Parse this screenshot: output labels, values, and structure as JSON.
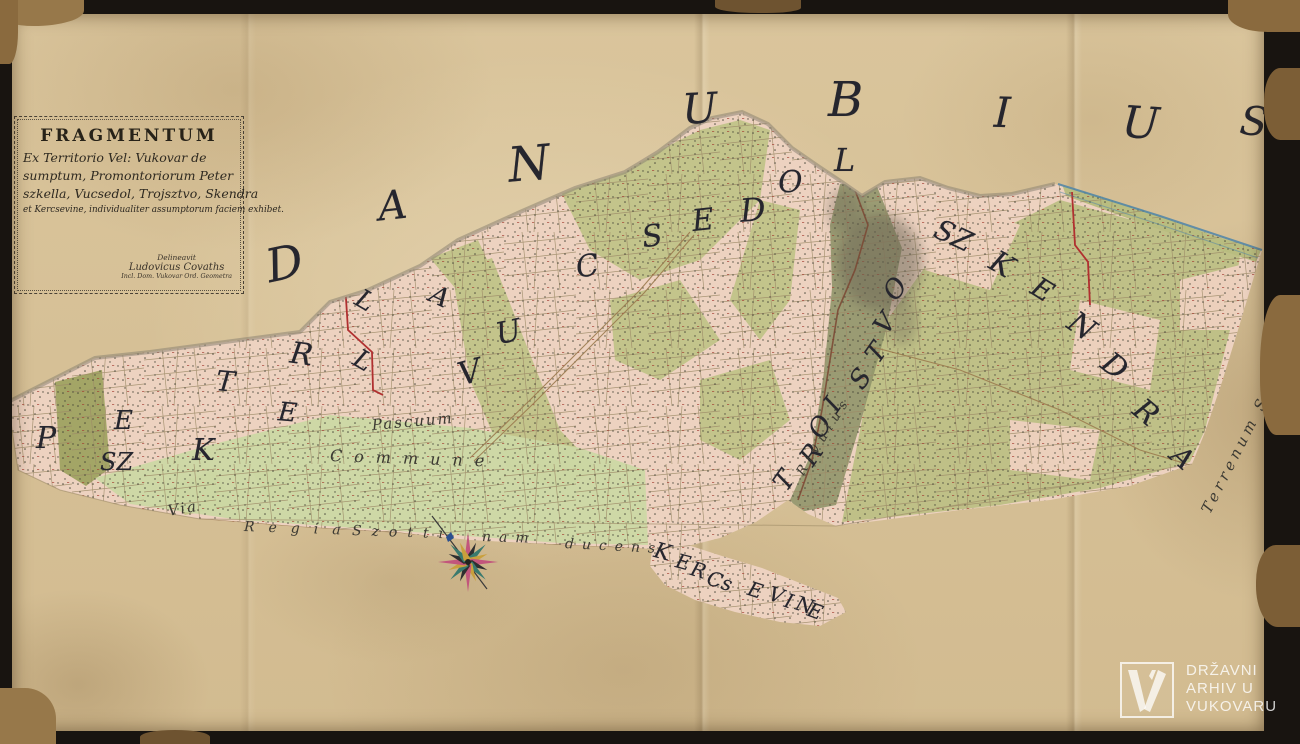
{
  "cartouche": {
    "title": "FRAGMENTUM",
    "line2": "Ex Territorio Vel: Vukovar de",
    "line3": "sumptum, Promontoriorum Peter",
    "line4": "szkella, Vucsedol, Trojsztvo, Skendra",
    "line5": "et Kercsevine, individualiter assumptorum faciem exhibet.",
    "signature": {
      "line1": "Delineavit",
      "line2": "Ludovicus Covaths",
      "line3": "Incl. Dom. Vukovar Ord. Geometra"
    }
  },
  "river_name": "DANUBIUS",
  "region_names": [
    "PETERSZKELLA",
    "VUCSEDOL",
    "TROISTVO",
    "SZKENDRA",
    "KERCSEVINE"
  ],
  "lettering": [
    {
      "name": "danubius",
      "cls": "river",
      "letters": [
        [
          "D",
          266,
          240,
          46,
          -12
        ],
        [
          "A",
          378,
          186,
          40,
          -6
        ],
        [
          "N",
          508,
          140,
          48,
          -5
        ],
        [
          "U",
          682,
          88,
          42,
          -3
        ],
        [
          "B",
          828,
          76,
          48,
          0
        ],
        [
          "I",
          994,
          92,
          42,
          2
        ],
        [
          "U",
          1122,
          102,
          44,
          4
        ],
        [
          "S",
          1240,
          102,
          40,
          6
        ]
      ]
    },
    {
      "name": "peterszkella",
      "cls": "region",
      "letters": [
        [
          "P",
          36,
          424,
          30,
          0
        ],
        [
          "E",
          114,
          408,
          26,
          0
        ],
        [
          "SZ",
          100,
          450,
          24,
          0
        ],
        [
          "K",
          192,
          436,
          30,
          0
        ],
        [
          "T",
          216,
          368,
          28,
          5
        ],
        [
          "E",
          278,
          400,
          26,
          5
        ],
        [
          "R",
          290,
          340,
          30,
          8
        ],
        [
          "L",
          354,
          348,
          26,
          30
        ],
        [
          "L",
          356,
          288,
          26,
          30
        ],
        [
          "A",
          430,
          284,
          26,
          25
        ]
      ]
    },
    {
      "name": "vucsedol",
      "cls": "region",
      "letters": [
        [
          "V",
          458,
          356,
          32,
          -15
        ],
        [
          "U",
          496,
          318,
          30,
          -12
        ],
        [
          "C",
          576,
          252,
          30,
          -10
        ],
        [
          "S",
          642,
          222,
          30,
          -8
        ],
        [
          "E",
          692,
          206,
          30,
          -6
        ],
        [
          "D",
          740,
          194,
          32,
          -4
        ],
        [
          "O",
          778,
          168,
          30,
          -2
        ],
        [
          "L",
          834,
          144,
          32,
          0
        ]
      ]
    },
    {
      "name": "troistvo",
      "cls": "region",
      "letters": [
        [
          "T",
          776,
          468,
          26,
          -55
        ],
        [
          "R",
          802,
          442,
          26,
          -55
        ],
        [
          "O",
          810,
          414,
          26,
          -55
        ],
        [
          "I",
          828,
          392,
          26,
          -55
        ],
        [
          "S",
          852,
          366,
          26,
          -55
        ],
        [
          "T",
          868,
          340,
          26,
          -55
        ],
        [
          "V",
          876,
          311,
          26,
          -55
        ],
        [
          "O",
          885,
          276,
          26,
          -55
        ]
      ]
    },
    {
      "name": "szkendra",
      "cls": "region",
      "letters": [
        [
          "SZ",
          934,
          222,
          28,
          25
        ],
        [
          "K",
          990,
          250,
          30,
          30
        ],
        [
          "E",
          1032,
          276,
          28,
          32
        ],
        [
          "N",
          1068,
          312,
          30,
          35
        ],
        [
          "D",
          1102,
          352,
          30,
          38
        ],
        [
          "R",
          1134,
          398,
          30,
          40
        ],
        [
          "A",
          1172,
          444,
          28,
          42
        ]
      ]
    },
    {
      "name": "kercsevine",
      "cls": "region",
      "letters": [
        [
          "K",
          654,
          542,
          22,
          15
        ],
        [
          "E",
          676,
          552,
          20,
          15
        ],
        [
          "R",
          691,
          560,
          20,
          17
        ],
        [
          "Cs",
          707,
          571,
          20,
          18
        ],
        [
          "E",
          748,
          580,
          20,
          18
        ],
        [
          "V",
          769,
          585,
          20,
          18
        ],
        [
          "I",
          785,
          591,
          20,
          18
        ],
        [
          "N",
          796,
          595,
          20,
          18
        ],
        [
          "E",
          808,
          601,
          20,
          20
        ]
      ]
    }
  ],
  "labels": [
    {
      "id": "pascuum",
      "text": "Pascuum",
      "x": 372,
      "y": 418,
      "size": 15,
      "rot": -5,
      "sp": 2
    },
    {
      "id": "commune",
      "text": "Commune",
      "x": 330,
      "y": 448,
      "size": 16,
      "rot": 2,
      "sp": 12
    },
    {
      "id": "via",
      "text": "Via",
      "x": 168,
      "y": 504,
      "size": 15,
      "rot": -10,
      "sp": 2
    },
    {
      "id": "regia",
      "text": "Regia",
      "x": 244,
      "y": 520,
      "size": 14,
      "rot": 2,
      "sp": 14
    },
    {
      "id": "szotti",
      "text": "Szotti",
      "x": 352,
      "y": 524,
      "size": 14,
      "rot": 2,
      "sp": 10
    },
    {
      "id": "nam",
      "text": "nam",
      "x": 482,
      "y": 530,
      "size": 14,
      "rot": 2,
      "sp": 8
    },
    {
      "id": "ducens",
      "text": "ducens",
      "x": 565,
      "y": 537,
      "size": 14,
      "rot": 3,
      "sp": 8
    },
    {
      "id": "terrenum-szottinense",
      "text": "Terrenum Szottinense",
      "x": 1206,
      "y": 505,
      "size": 15,
      "rot": -63,
      "sp": 4
    },
    {
      "id": "rivulus",
      "text": "Rivulus",
      "x": 800,
      "y": 468,
      "size": 13,
      "rot": -58,
      "sp": 6
    }
  ],
  "watermark": {
    "line1": "DRŽAVNI",
    "line2": "ARHIV U",
    "line3": "VUKOVARU"
  },
  "colors": {
    "parchment": "#dac59c",
    "frame_black": "#181410",
    "damage_brown": "#8a6a3e",
    "parcel_pink": "#edd2c0",
    "parcel_olive": "#c3c48b",
    "meadow_green": "#ccd8a4",
    "valley_green": "#90956a",
    "ink": "#26262e",
    "boundary_red": "#b03030",
    "road_brown": "#9b7b4f",
    "stream_brown": "#7a4633",
    "danube_blue": "#4e84a8",
    "watermark_white": "#ffffff"
  }
}
